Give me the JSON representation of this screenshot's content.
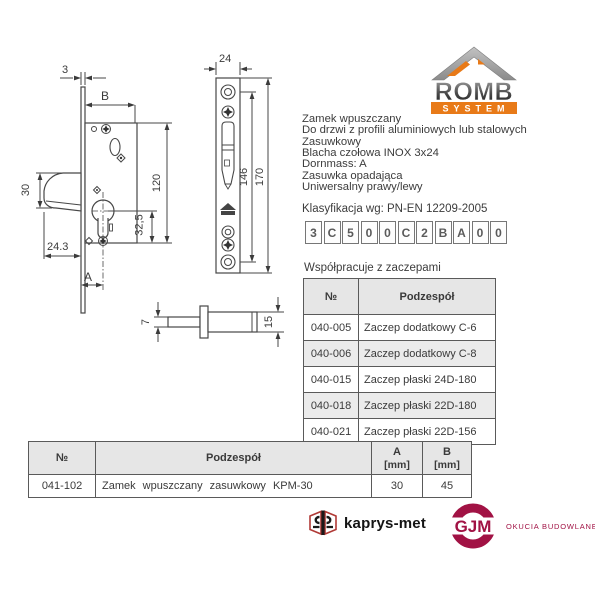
{
  "logo": {
    "name": "ROMB",
    "subtitle": "SYSTEM"
  },
  "description": {
    "lines": [
      "Zamek wpuszczany",
      "Do drzwi z profili aluminiowych lub stalowych",
      "Zasuwkowy",
      "Blacha czołowa INOX 3x24",
      "Dornmass: A",
      "Zasuwka opadająca",
      "Uniwersalny prawy/lewy"
    ]
  },
  "classification": {
    "label": "Klasyfikacja wg: PN-EN 12209-2005",
    "code": [
      "3",
      "C",
      "5",
      "0",
      "0",
      "C",
      "2",
      "B",
      "A",
      "0",
      "0"
    ]
  },
  "compat": {
    "title": "Współpracuje z zaczepami",
    "headers": {
      "no": "№",
      "part": "Podzespół"
    },
    "rows": [
      {
        "no": "040-005",
        "part": "Zaczep dodatkowy C-6"
      },
      {
        "no": "040-006",
        "part": "Zaczep dodatkowy C-8"
      },
      {
        "no": "040-015",
        "part": "Zaczep płaski 24D-180"
      },
      {
        "no": "040-018",
        "part": "Zaczep płaski 22D-180"
      },
      {
        "no": "040-021",
        "part": "Zaczep płaski 22D-156"
      }
    ]
  },
  "product": {
    "headers": {
      "no": "№",
      "part": "Podzespół",
      "a": "A",
      "b": "B",
      "unit": "[mm]"
    },
    "row": {
      "no": "041-102",
      "part": "Zamek wpuszczany zasuwkowy KPM-30",
      "a": "30",
      "b": "45"
    }
  },
  "drawings": {
    "lock_side": {
      "dims": {
        "plate_thickness": "3",
        "b": "B",
        "body_height": "120",
        "bolt_height": "30",
        "bolt_projection": "24.3",
        "cylinder_offset": "32,5",
        "a": "A"
      }
    },
    "faceplate": {
      "dims": {
        "width": "24",
        "hole_span": "146",
        "height": "170"
      }
    },
    "pin": {
      "dims": {
        "shaft": "7",
        "body": "15"
      }
    }
  },
  "footer": {
    "kaprys": "kaprys-met",
    "gjm": "GJM",
    "gjm_tagline": "OKUCIA BUDOWLANE"
  },
  "colors": {
    "accent_orange": "#e87a18",
    "brand_maroon": "#a11244",
    "line": "#474747"
  }
}
